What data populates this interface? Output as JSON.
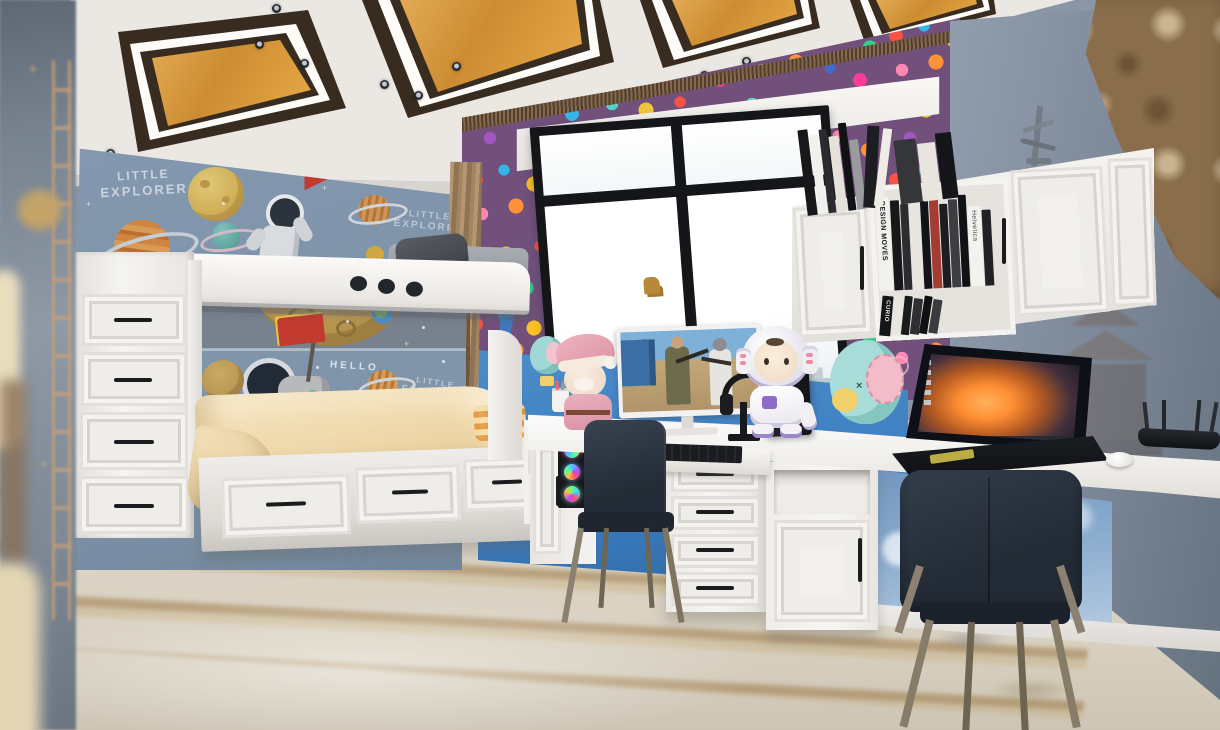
{
  "scene": {
    "description": "3D interior render of a space-themed children's bedroom with bunk bed, study desks and balloon wallpaper"
  },
  "wall_art": {
    "explorer_line1": "LITTLE",
    "explorer_line2": "EXPLORER",
    "hello": "HELLO"
  },
  "bookshelf": {
    "spine_design_moves": "DESIGN MOVES",
    "spine_helvetica": "Helvetica",
    "spine_curio": "CURIO"
  },
  "colors": {
    "wall_blue_grey": "#7e93a9",
    "accent_blue_wall": "#3c7ec1",
    "balloon_wall_base": "#6e5278",
    "ceiling_wood": "#dfa449",
    "furniture_white": "#f2f1ee",
    "bedding_cream": "#efd9ae",
    "chair_navy": "#2c3442",
    "floor_beige": "#d7cfc0",
    "curtain_brown": "#8a6e4b",
    "flag_red": "#c23b2e",
    "laptop_nebula_orange": "#ff9d42"
  }
}
